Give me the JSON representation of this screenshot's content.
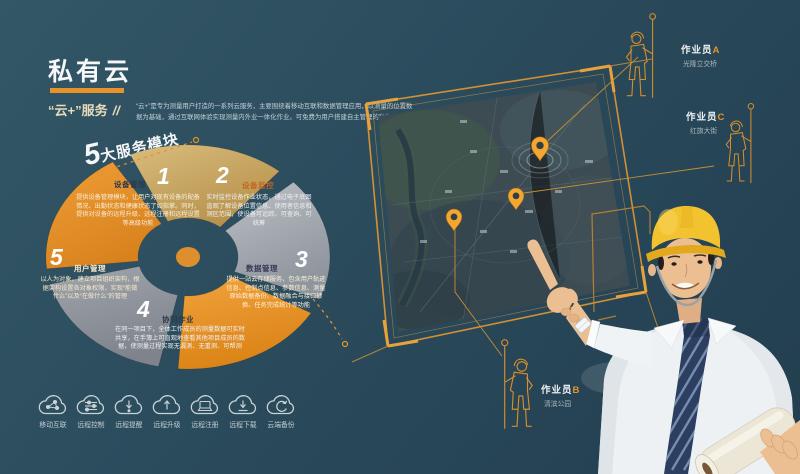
{
  "header": {
    "title": "私有云",
    "subtitle_quoted": "“云+”",
    "subtitle_rest": "服务",
    "subtitle_slashes": "//",
    "description_line1": "“云+”是专为测量用户打造的一系列云服务，主要围绕着移动互联和数据管理应用，以测量的位置数",
    "description_line2": "据为基础，通过互联网体验实现测量内外业一体化作业。可免费为用户搭建自主管理的私有云服务。"
  },
  "modules": {
    "heading_number": "5",
    "heading_suffix": "大服务模块",
    "items": [
      {
        "number": "1",
        "label": "设备管理",
        "text": "提供设备管理模块，让用户对现有设备的配备情况、出勤状态和健康状态了如指掌。同时，提供对设备的远程升级、远程注册和远程设置等高级功能"
      },
      {
        "number": "2",
        "label": "设备监控",
        "text": "实时监控设备作业状态，通过电子底图直观了解设备位置信息、使用者信息和测区范围，使设备可追踪、可查询、可统筹"
      },
      {
        "number": "3",
        "label": "数据管理",
        "text": "提供一站云存储服务，包含用户轨迹信息、控制点信息、参数信息、测量原始数据备份、数据融合与接口转换、任务完成统计等功能"
      },
      {
        "number": "4",
        "label": "协同作业",
        "text": "在同一项目下，全体工作成员的测量数据可实时共享，在手簿上可直观地查看其他项目成员的数据，使测量过程实现无漏测、无重测、可帮测"
      },
      {
        "number": "5",
        "label": "用户管理",
        "text": "以人为对象，建立项目组织架构，根据架构设置各对象权限，实现“能做什么”以及“在做什么”的管理"
      }
    ]
  },
  "workers": [
    {
      "role": "作业员",
      "letter": "A",
      "location": "光隆立交桥"
    },
    {
      "role": "作业员",
      "letter": "C",
      "location": "红旗大街"
    },
    {
      "role": "作业员",
      "letter": "B",
      "location": "清滨公园"
    }
  ],
  "footer": {
    "icons": [
      {
        "id": "mobile-internet-icon",
        "label": "移动互联"
      },
      {
        "id": "remote-control-icon",
        "label": "远程控制"
      },
      {
        "id": "remote-reminder-icon",
        "label": "远程提醒"
      },
      {
        "id": "remote-upgrade-icon",
        "label": "远程升级"
      },
      {
        "id": "remote-register-icon",
        "label": "远程注册"
      },
      {
        "id": "remote-download-icon",
        "label": "远程下载"
      },
      {
        "id": "cloud-backup-icon",
        "label": "云端备份"
      }
    ]
  },
  "colors": {
    "accent": "#E8922A",
    "background": "#2B4C5D",
    "sector_tan": "#C9A662",
    "sector_gray": "#A7ADB4",
    "sector_orange": "#E8922A",
    "helmet_yellow": "#F2C12E"
  }
}
